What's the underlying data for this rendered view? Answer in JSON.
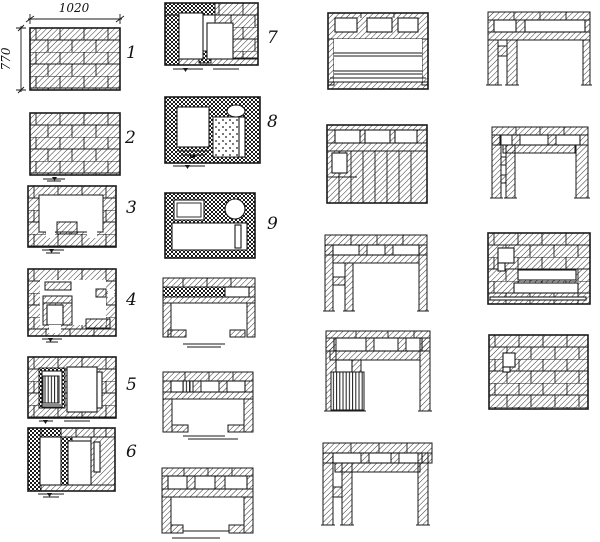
{
  "palette": {
    "ink": "#1a1a1a",
    "paper": "#ffffff"
  },
  "dimension_labels": {
    "width": "1020",
    "height": "770"
  },
  "course_labels": [
    "1",
    "2",
    "3",
    "4",
    "5",
    "6",
    "7",
    "8",
    "9"
  ]
}
